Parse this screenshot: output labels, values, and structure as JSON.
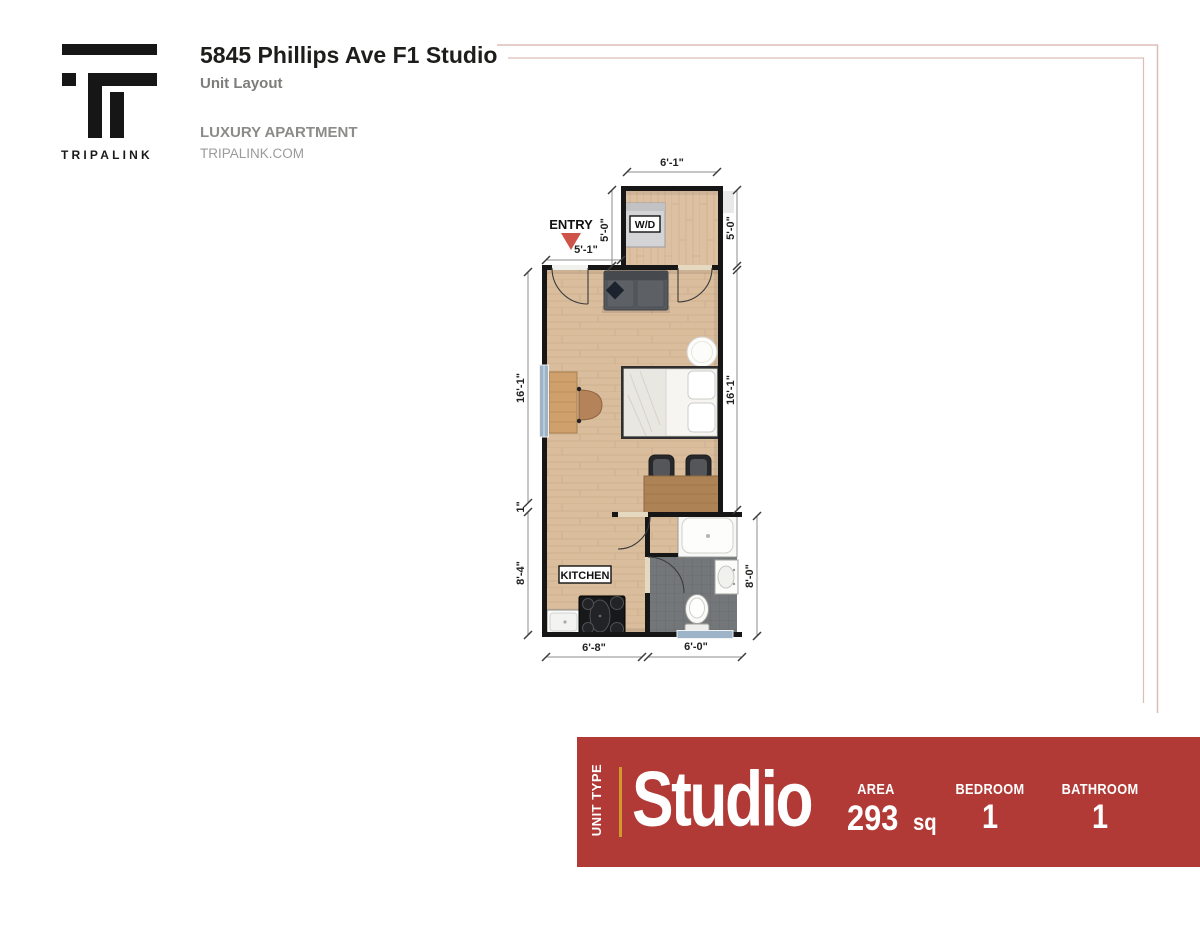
{
  "header": {
    "logo_text": "TRIPALINK",
    "title": "5845 Phillips Ave F1 Studio",
    "subtitle": "Unit Layout",
    "tagline": "LUXURY APARTMENT",
    "website": "TRIPALINK.COM"
  },
  "floorplan": {
    "labels": {
      "entry": "ENTRY",
      "wd": "W/D",
      "kitchen": "KITCHEN"
    },
    "dimensions": {
      "top_width": "6'-1\"",
      "laundry_left": "5'-0\"",
      "laundry_right": "5'-0\"",
      "entry_width": "5'-1\"",
      "main_left": "16'-1\"",
      "main_right": "16'-1\"",
      "jog": "1\"",
      "kitchen_left": "8'-4\"",
      "bath_right": "8'-0\"",
      "bottom_kitchen": "6'-8\"",
      "bottom_bath": "6'-0\""
    }
  },
  "banner": {
    "unit_type_label": "UNIT TYPE",
    "unit_type_value": "Studio",
    "area_label": "AREA",
    "area_value": "293",
    "area_unit": "sq",
    "bedroom_label": "BEDROOM",
    "bedroom_value": "1",
    "bathroom_label": "BATHROOM",
    "bathroom_value": "1"
  },
  "colors": {
    "banner_red": "#b13a36",
    "accent_gold": "#d29a2d",
    "frame_pink": "#ddbdb8",
    "entry_marker_red": "#ce5449",
    "wall_black": "#161616",
    "floor_wood": "#dabd9d",
    "bath_tile": "#73777a",
    "window_blue": "#9db4c8"
  }
}
